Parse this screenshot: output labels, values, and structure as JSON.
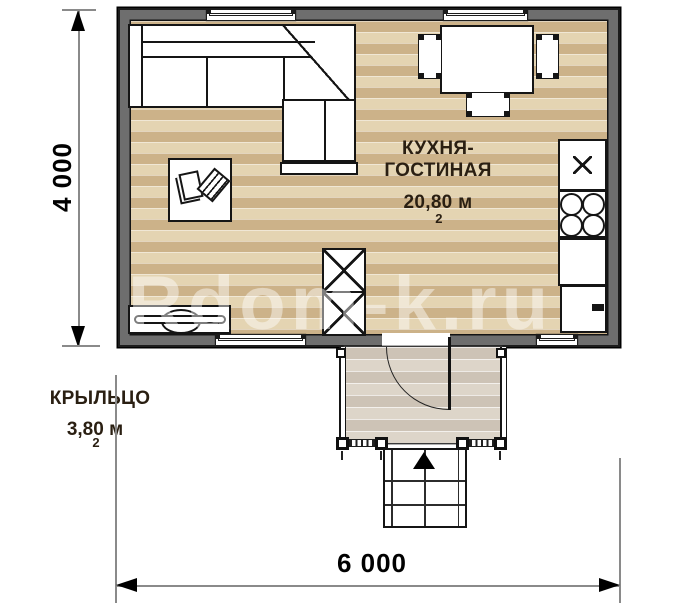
{
  "watermark": {
    "text": "Rdom-k.ru"
  },
  "dimensions": {
    "height_mm": "4 000",
    "width_mm": "6 000"
  },
  "rooms": {
    "kitchen_living": {
      "name_line1": "КУХНЯ-",
      "name_line2": "ГОСТИНАЯ",
      "area": "20,80 м",
      "area_exp": "2"
    },
    "porch": {
      "name": "КРЫЛЬЦО",
      "area": "3,80 м",
      "area_exp": "2"
    }
  },
  "colors": {
    "wall": "#6e6e6e",
    "wall_outline": "#1c1c1c",
    "floor_plank_dark": "#ccb289",
    "floor_plank_light": "#e4d4b2",
    "porch_plank_dark": "#cdc3b6",
    "porch_plank_light": "#ddd5c9",
    "label_text": "#2a1f12"
  }
}
